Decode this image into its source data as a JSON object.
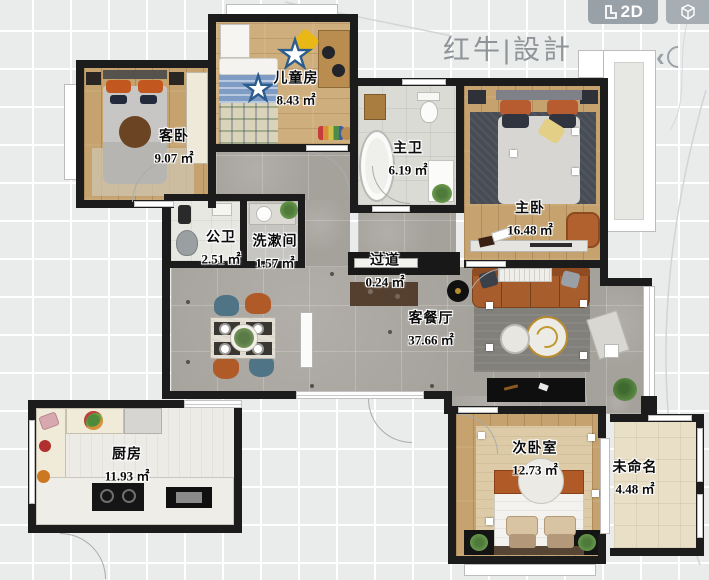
{
  "watermark": {
    "text": "红牛|設計"
  },
  "toolbar": {
    "mode_2d_label": "2D"
  },
  "icons": {
    "star": "★",
    "chevron_left": "‹"
  },
  "rooms": [
    {
      "name": "客卧",
      "area_label": "9.07 ㎡"
    },
    {
      "name": "儿童房",
      "area_label": "8.43 ㎡"
    },
    {
      "name": "主卫",
      "area_label": "6.19 ㎡"
    },
    {
      "name": "主卧",
      "area_label": "16.48 ㎡"
    },
    {
      "name": "公卫",
      "area_label": "2.51 ㎡"
    },
    {
      "name": "洗漱间",
      "area_label": "1.57 ㎡"
    },
    {
      "name": "过道",
      "area_label": "0.24 ㎡"
    },
    {
      "name": "客餐厅",
      "area_label": "37.66 ㎡"
    },
    {
      "name": "厨房",
      "area_label": "11.93 ㎡"
    },
    {
      "name": "次卧室",
      "area_label": "12.73 ㎡"
    },
    {
      "name": "未命名",
      "area_label": "4.48 ㎡"
    }
  ],
  "colors": {
    "wall": "#1c1c1c",
    "wood_floor": "#c5a26e",
    "gray_tile": "#a5a19b",
    "accent_orange": "#b05a28",
    "accent_teal": "#4e7486",
    "ui_button": "#99a1a8"
  }
}
